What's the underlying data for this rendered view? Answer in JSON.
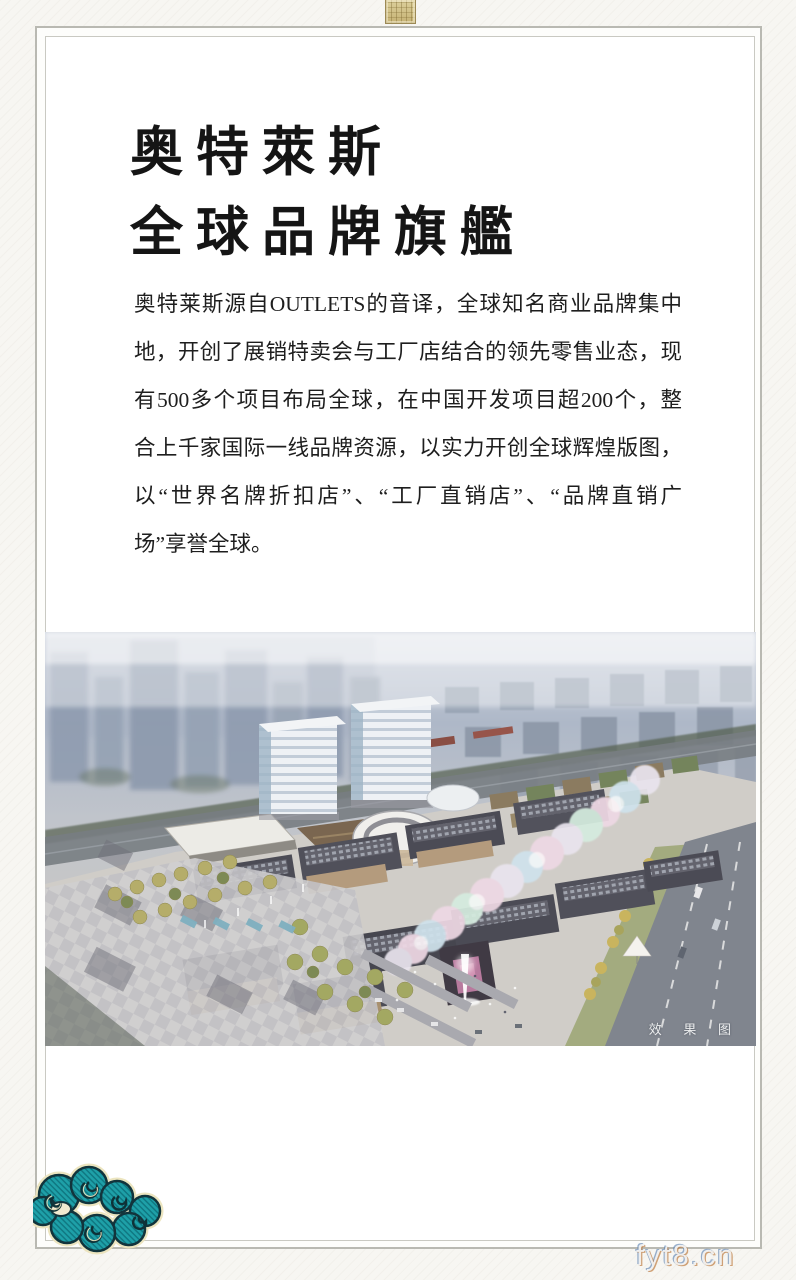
{
  "page": {
    "background_color": "#f7f6f2",
    "frame_color": "#b9b9b2"
  },
  "header": {
    "title_line1": "奥特萊斯",
    "title_line2": "全球品牌旗艦"
  },
  "body": {
    "lines": [
      "奥特莱斯源自OUTLETS的音译，全球知名商业品牌集中",
      "地，开创了展销特卖会与工厂店结合的领先零售业态，现",
      "有500多个项目布局全球，在中国开发项目超200个，整",
      "合上千家国际一线品牌资源，以实力开创全球辉煌版图，",
      "以“世界名牌折扣店”、“工厂直销店”、“品牌直销广",
      "场”享誉全球。"
    ]
  },
  "photo": {
    "caption": "效 果 图"
  },
  "watermark": {
    "text": "fyt8.cn"
  },
  "ornaments": {
    "cloud_color": "#1ea0a8",
    "seal_color": "#cdbb83"
  }
}
